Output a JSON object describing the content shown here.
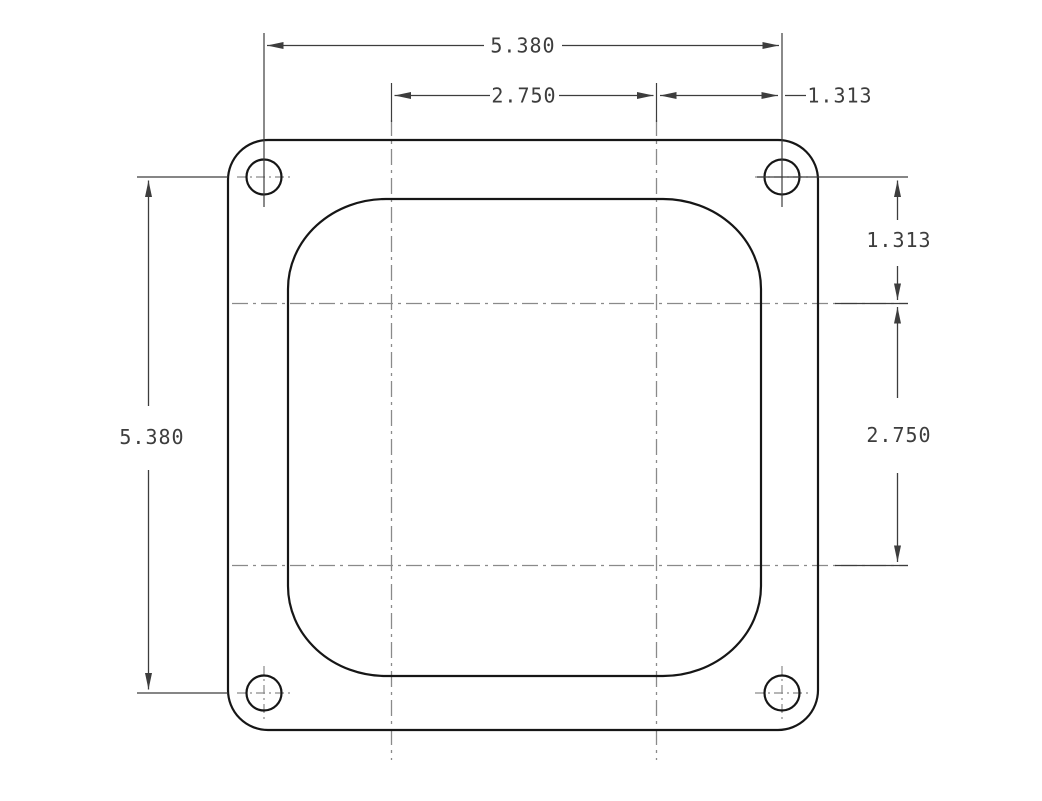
{
  "drawing": {
    "kind": "engineering-dimension-drawing",
    "background": "#ffffff",
    "colors": {
      "outline": "#161616",
      "dimension": "#3d3d3d",
      "centerline": "#8a8a8a"
    },
    "part": {
      "outer_shape": "square flange with rounded corners",
      "inner_shape": "large rounded-square opening",
      "bolt_holes": 4
    },
    "labels": {
      "dim_top_overall": "5.380",
      "dim_top_bore_spacing": "2.750",
      "dim_top_right_offset": "1.313",
      "dim_right_top_offset": "1.313",
      "dim_right_bore_spacing": "2.750",
      "dim_left_overall": "5.380"
    }
  }
}
